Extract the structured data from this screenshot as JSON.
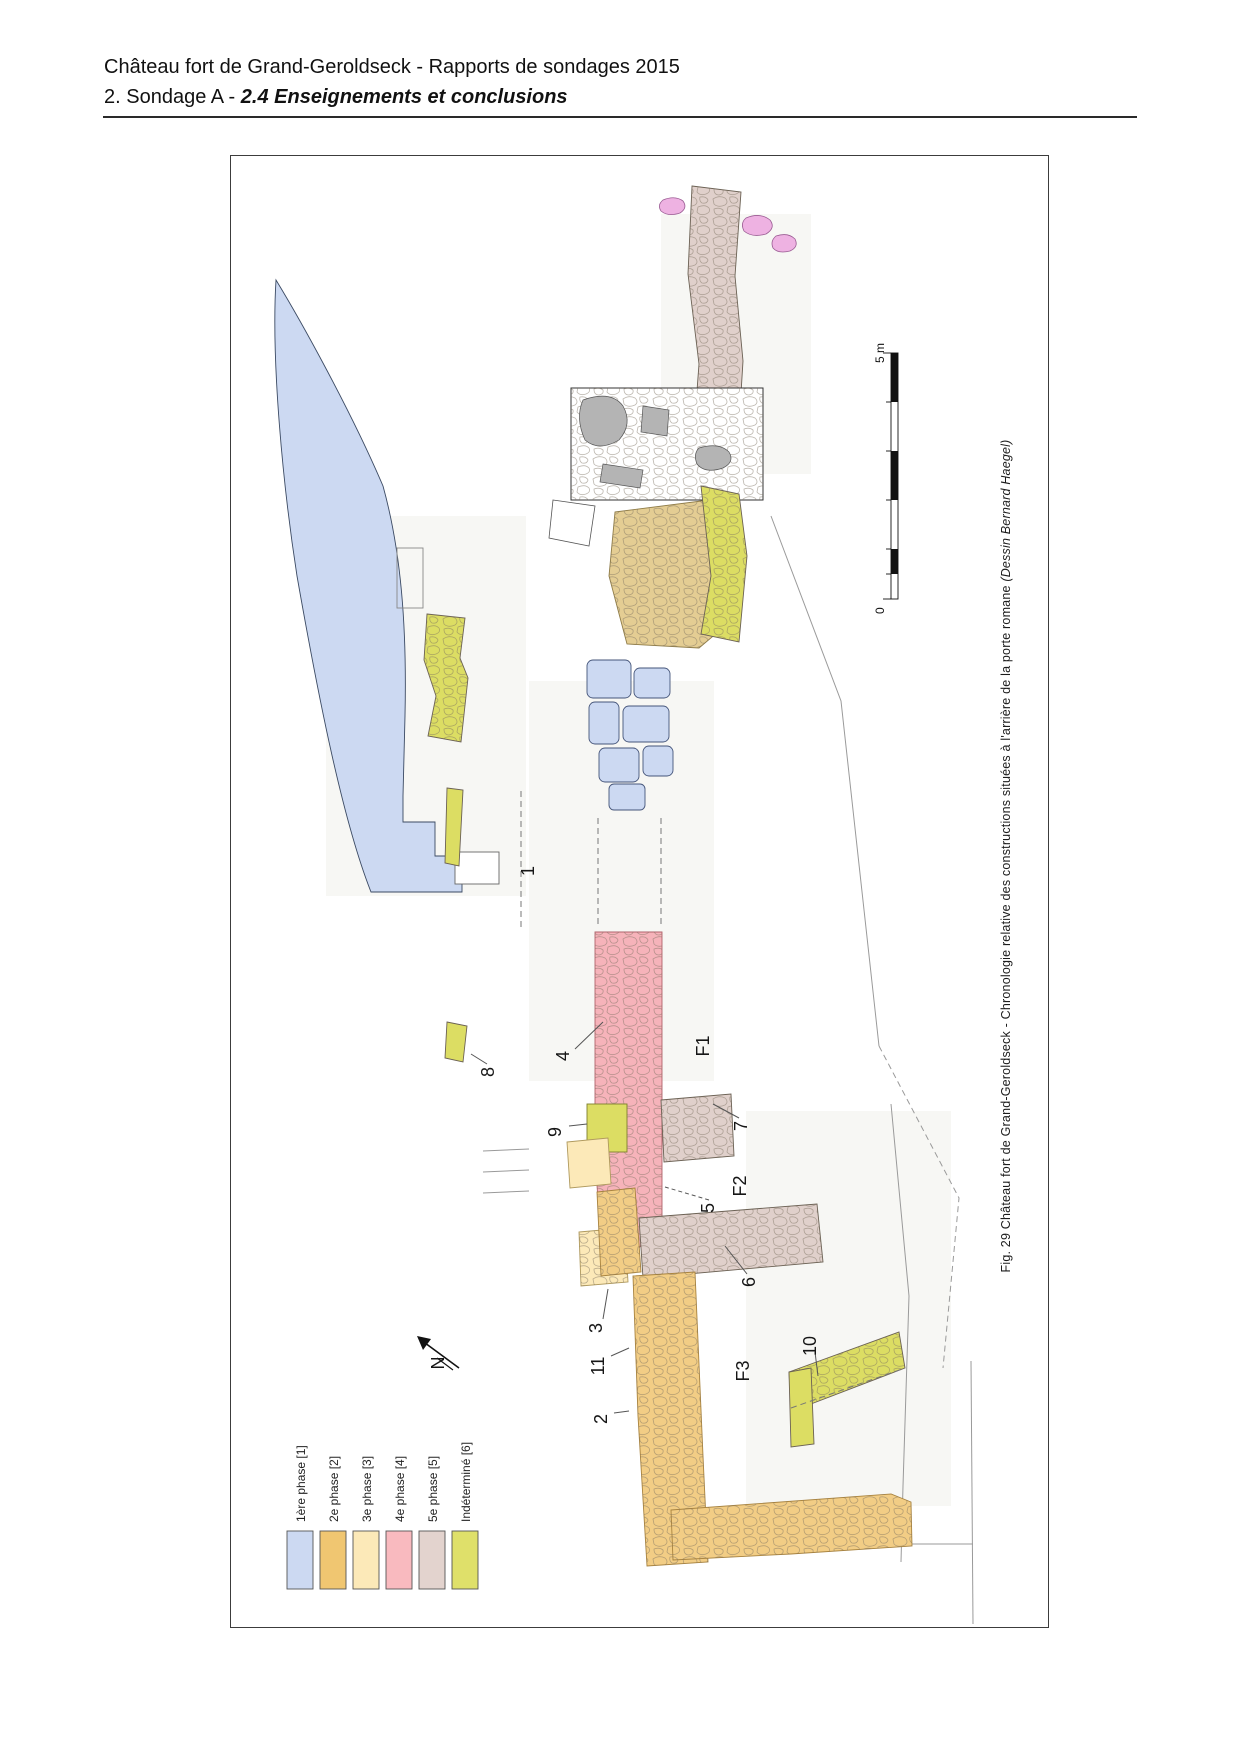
{
  "page": {
    "title_line": "Château fort de Grand-Geroldseck - Rapports de sondages 2015",
    "section_prefix": "2. Sondage A - ",
    "section_emphasis": "2.4 Enseignements et conclusions"
  },
  "figure": {
    "caption_text": "Fig. 29 Château fort de Grand-Geroldseck - Chronologie relative des constructions situées à l'arrière de la porte romane ",
    "caption_credit": "(Dessin Bernard Haegel)",
    "north_label": "N",
    "scale": {
      "zero": "0",
      "five": "5 m"
    },
    "plan_labels": [
      "1",
      "8",
      "4",
      "9",
      "F1",
      "7",
      "F2",
      "5",
      "6",
      "3",
      "11",
      "2",
      "F3",
      "10"
    ],
    "legend": {
      "items": [
        {
          "label": "1ère phase [1]",
          "color": "#ccd9f2"
        },
        {
          "label": "2e phase [2]",
          "color": "#f0c671"
        },
        {
          "label": "3e phase [3]",
          "color": "#fce9b8"
        },
        {
          "label": "4e phase [4]",
          "color": "#f9babf"
        },
        {
          "label": "5e phase [5]",
          "color": "#e3d3ce"
        },
        {
          "label": "Indéterminé [6]",
          "color": "#dfe06a"
        }
      ]
    }
  }
}
